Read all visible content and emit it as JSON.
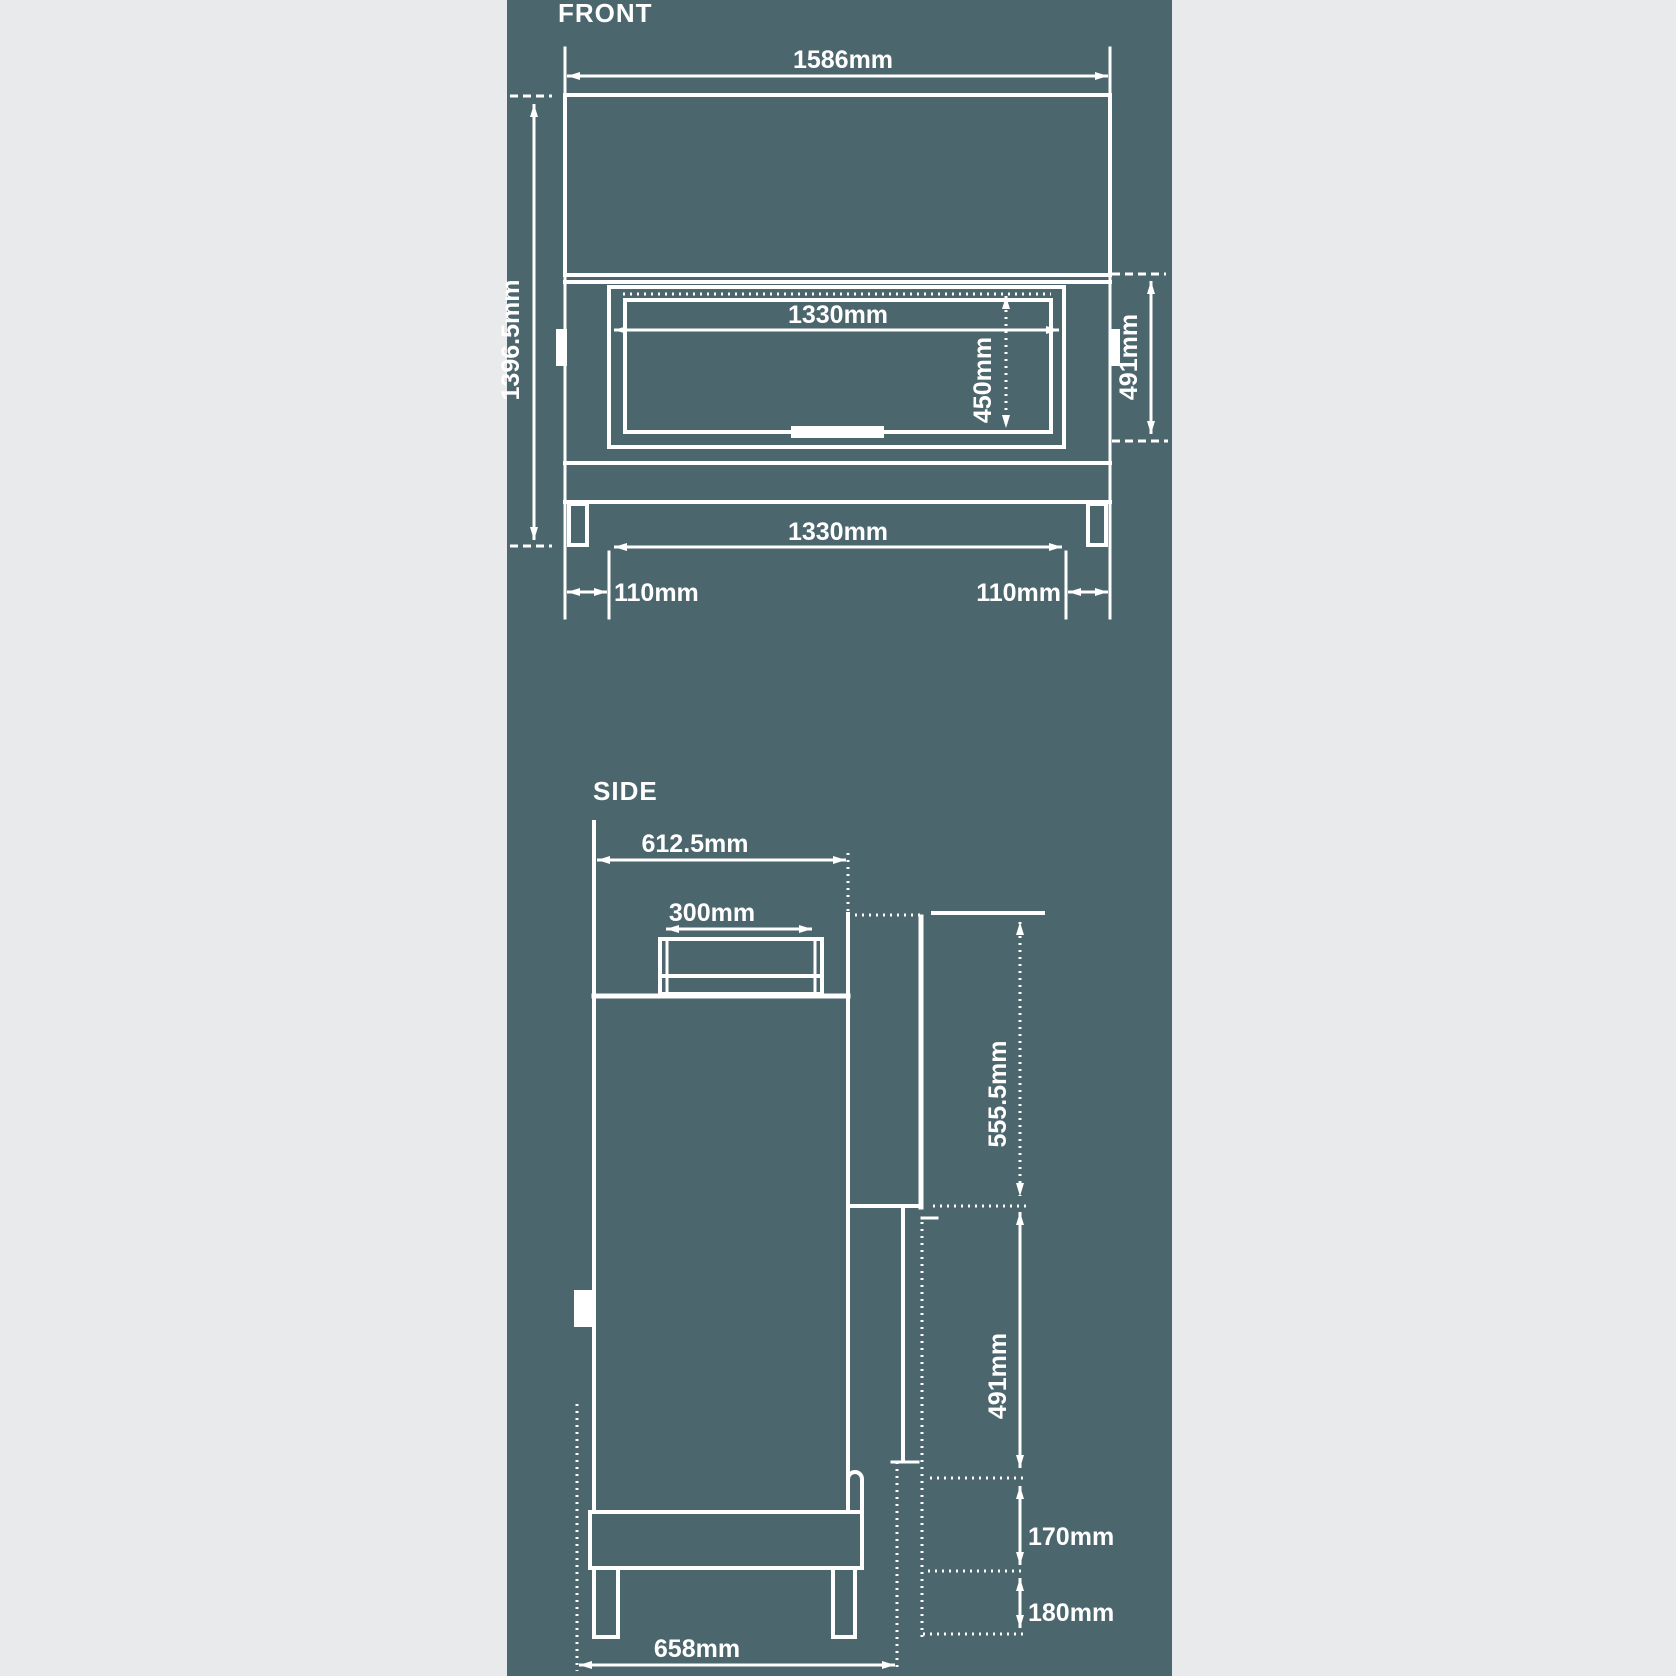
{
  "colors": {
    "page": "#e9eaeb",
    "panel": "#4c666d",
    "line": "#ffffff"
  },
  "front": {
    "title": "FRONT",
    "overall_width": "1586mm",
    "overall_height": "1396.5mm",
    "opening_width": "1330mm",
    "opening_height": "450mm",
    "firebox_height": "491mm",
    "leg_span": "1330mm",
    "leg_inset_left": "110mm",
    "leg_inset_right": "110mm"
  },
  "side": {
    "title": "SIDE",
    "top_depth": "612.5mm",
    "flue_width": "300mm",
    "upper_height": "555.5mm",
    "firebox_height": "491mm",
    "plinth_height": "170mm",
    "leg_height": "180mm",
    "base_depth": "658mm"
  }
}
